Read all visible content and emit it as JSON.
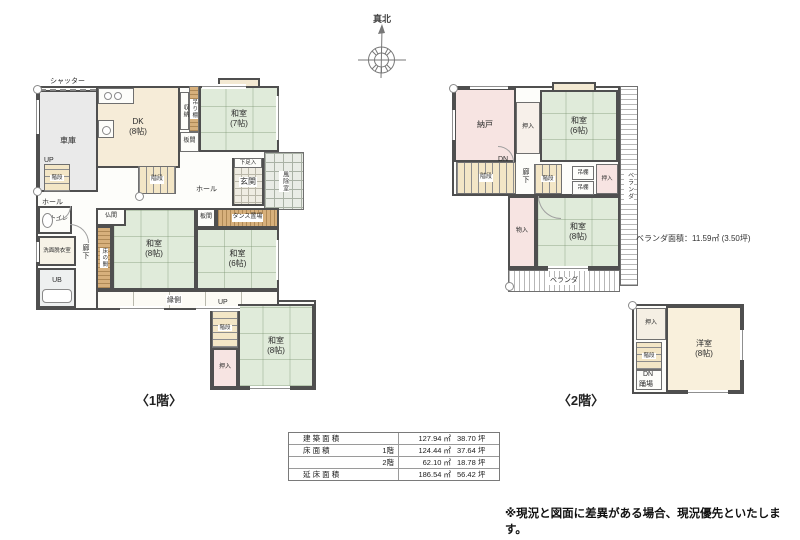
{
  "compass": {
    "label": "真北"
  },
  "f1": {
    "caption": "〈1階〉",
    "shutter": "シャッター",
    "garage": "車庫",
    "up1": "UP",
    "stairs1": "階段",
    "dk": "DK\n(8帖)",
    "shuno": "収納",
    "tsuridana": "吊り棚",
    "washitsu7": "和室\n(7帖)",
    "itanoma1": "板間",
    "getabako": "下足入",
    "genkan": "玄関",
    "fujo": "風除室",
    "hall1": "ホール",
    "stairs2": "階段",
    "hall2": "ホール",
    "toilet": "トイレ",
    "senmen": "洗面脱衣室",
    "ub": "UB",
    "rouka": "廊下",
    "butsuma": "仏間",
    "tokonoma": "床の間",
    "washitsu8a": "和室\n(8帖)",
    "itanoma2": "板間",
    "tansu": "タンス置場",
    "washitsu6": "和室\n(6帖)",
    "engawa": "縁側",
    "up2": "UP",
    "stairs3": "階段",
    "oshiire1": "押入",
    "washitsu8b": "和室\n(8帖)"
  },
  "f2": {
    "caption": "〈2階〉",
    "nando": "納戸",
    "oshiire_a": "押入",
    "washitsu6": "和室\n(6帖)",
    "dn1": "DN",
    "stairs1": "階段",
    "rouka": "廊下",
    "stairs2": "階段",
    "tana1": "吊棚",
    "tana2": "吊棚",
    "oshiire_b": "押入",
    "monoiri": "物入",
    "washitsu8": "和室\n(8帖)",
    "veranda_right": "ベランダ",
    "veranda_bottom": "ベランダ",
    "veranda_note": "ベランダ面積：11.59㎡ (3.50坪)",
    "oshiire_c": "押入",
    "stairs3": "階段",
    "dn2": "DN",
    "odoriba": "踊場",
    "youshitsu": "洋室\n(8帖)"
  },
  "area_table": {
    "rows": [
      {
        "label": "建 築 面 積",
        "sub": "",
        "sqm": "127.94 ㎡",
        "tsubo": "38.70 坪"
      },
      {
        "label": "床 面 積",
        "sub": "1階",
        "sqm": "124.44 ㎡",
        "tsubo": "37.64 坪"
      },
      {
        "label": "",
        "sub": "2階",
        "sqm": "62.10 ㎡",
        "tsubo": "18.78 坪"
      },
      {
        "label": "延 床 面 積",
        "sub": "",
        "sqm": "186.54 ㎡",
        "tsubo": "56.42 坪"
      }
    ]
  },
  "disclaimer": "※現況と図面に差異がある場合、現況優先といたします。",
  "colors": {
    "wall": "#4f4f4f",
    "tatami": "#e0ebda",
    "wood": "#d7b07c",
    "pink": "#f7e4e2",
    "cream": "#f6ecd8",
    "garage_gray": "#eaeaea"
  }
}
